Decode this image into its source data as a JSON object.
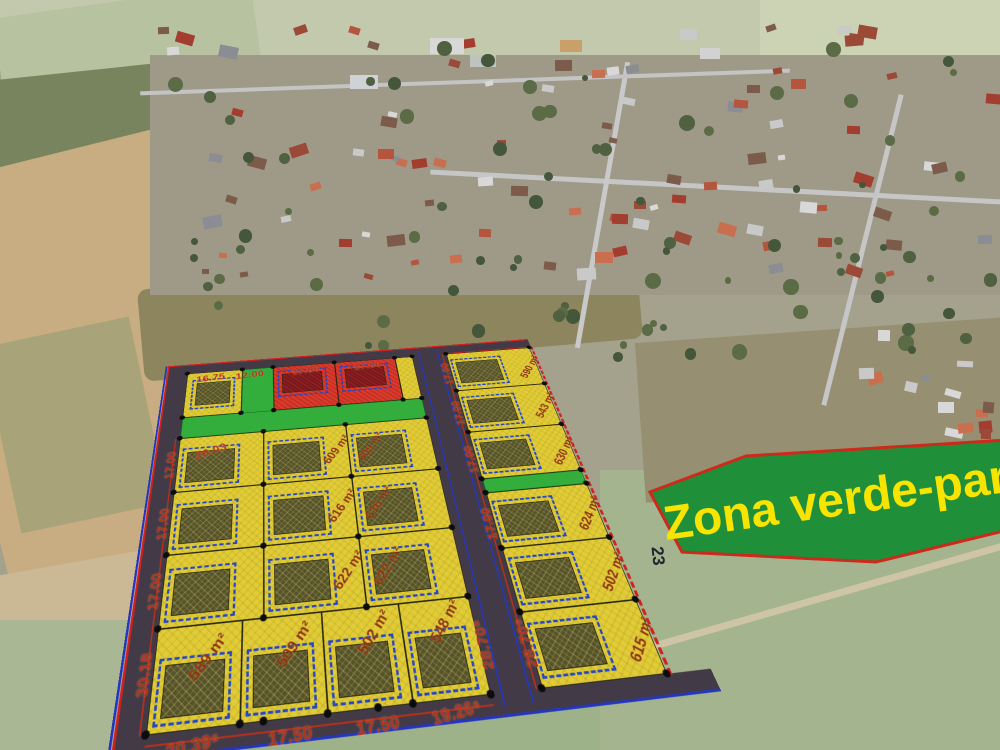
{
  "banner": {
    "label": "Zona verde-parc"
  },
  "plan": {
    "road_label": "23",
    "left_block": {
      "corner_dim": "16.75",
      "green_dim": "12.00",
      "red_dims": [
        "17.00",
        "17.00"
      ],
      "diag_dim": "26.03",
      "side_dims": [
        "17.00",
        "17.00",
        "17.00",
        "30.18"
      ],
      "mid_areas": [
        "609 m²",
        "609 m²",
        "616 m²",
        "616 m²",
        "622 m²",
        "622 m²"
      ],
      "bottom_areas": [
        "589 m²",
        "509 m²",
        "502 m²",
        "548 m²"
      ],
      "bottom_dims": [
        "20.39⁵",
        "17.50",
        "17.50",
        "19.26⁶"
      ],
      "right_dim": "28.70⁵"
    },
    "right_block": {
      "areas": [
        "590 m²",
        "543 m²",
        "630 m²",
        "624 m²",
        "502 m²",
        "615 m²"
      ],
      "side_dims": [
        "17.00",
        "17.00",
        "17.00",
        "17.00",
        "28.70⁵"
      ]
    },
    "colors": {
      "plot_yellow": "#e2cc36",
      "reserved_red": "#d83a2b",
      "green_zone": "#33ad3c",
      "building": "#56532b",
      "building_red": "#7c181c",
      "road": "#423b47",
      "dim_text": "#b5301c",
      "setback_blue": "#2446c8",
      "boundary_blue": "#2436c0",
      "boundary_red": "#d02020",
      "banner_green": "#1f8f3a",
      "banner_text": "#f7e400",
      "banner_border": "#cc2a1a"
    }
  }
}
